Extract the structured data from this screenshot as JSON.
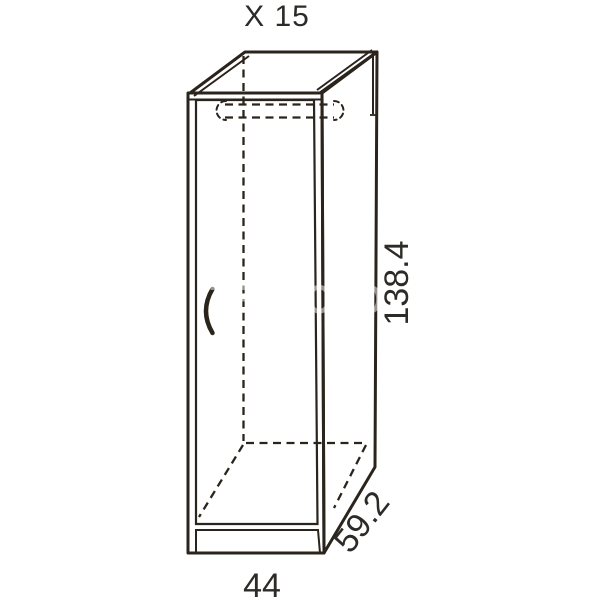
{
  "title": "X 15",
  "dimensions": {
    "height": "138.4",
    "depth": "59.2",
    "width": "44"
  },
  "watermark": "TEKPOLOD",
  "colors": {
    "top_face": "#d8c3a4",
    "side_face": "#cdb695",
    "front_edge": "#eee5cf",
    "door": "#f4eddb",
    "outline": "#2a241c",
    "text": "#2d2b28"
  }
}
